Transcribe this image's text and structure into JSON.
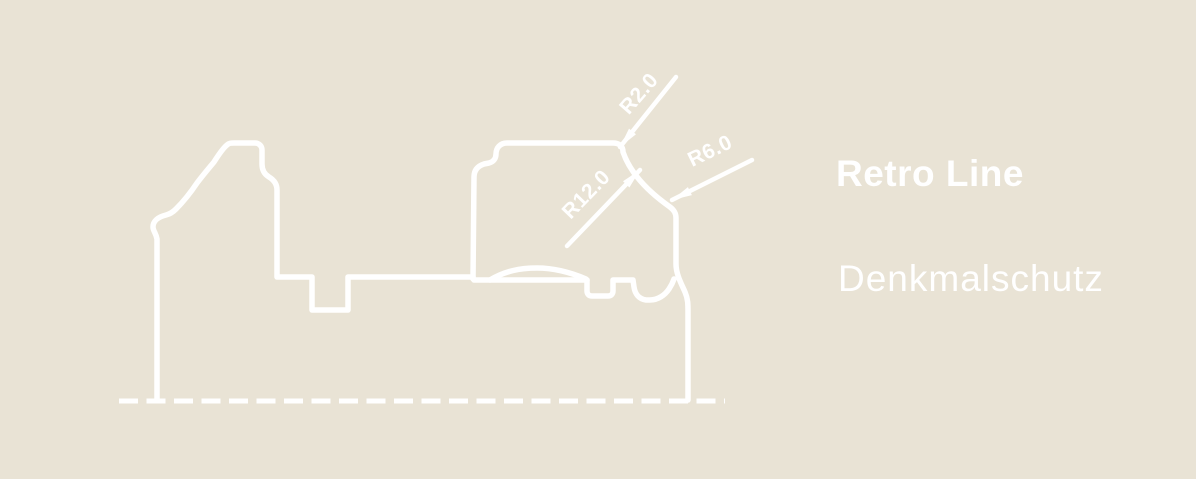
{
  "product": {
    "name": "Retro Line",
    "variant": "Denkmalschutz"
  },
  "drawing": {
    "type": "profile-cross-section",
    "dimensions": {
      "r2": "R2.0",
      "r12": "R12.0",
      "r6": "R6.0"
    }
  },
  "colors": {
    "background": "#e9e3d5",
    "line": "#ffffff",
    "text": "#ffffff"
  }
}
